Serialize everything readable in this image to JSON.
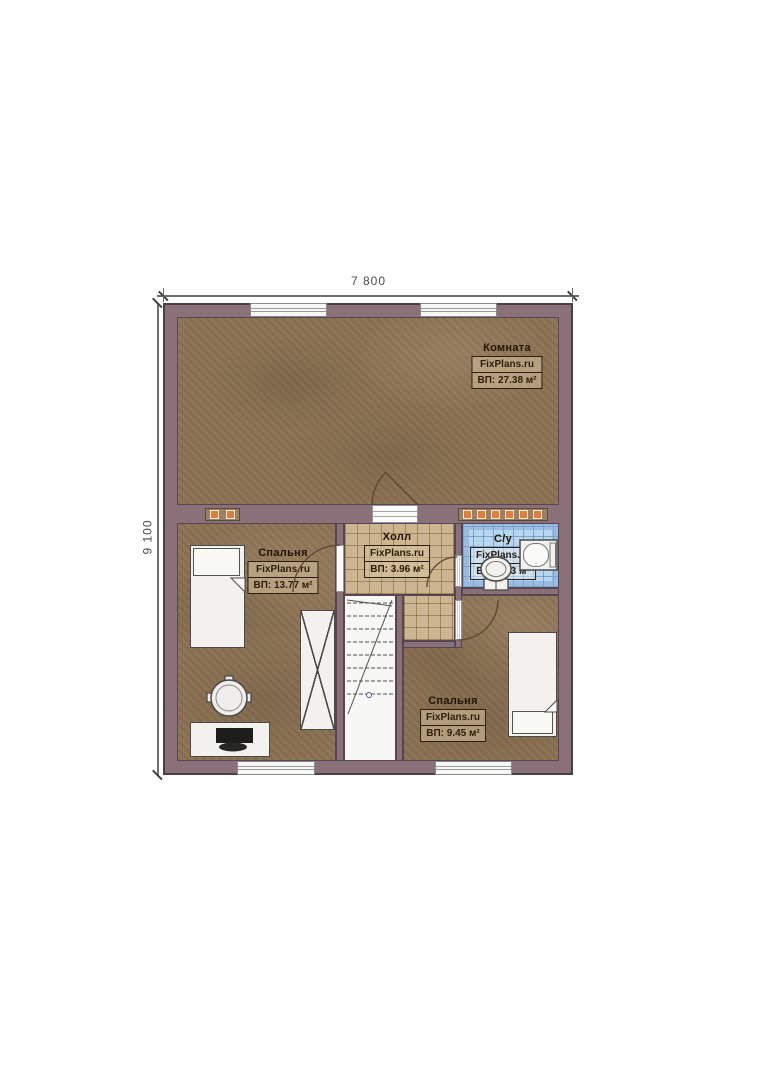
{
  "plan": {
    "dimensions": {
      "width": "7 800",
      "height": "9 100"
    },
    "rooms": [
      {
        "name": "Комната",
        "watermark": "FixPlans.ru",
        "area": "ВП: 27.38 м²"
      },
      {
        "name": "Спальня",
        "watermark": "FixPlans.ru",
        "area": "ВП: 13.77 м²"
      },
      {
        "name": "Холл",
        "watermark": "FixPlans.ru",
        "area": "ВП: 3.96 м²"
      },
      {
        "name": "С/у",
        "watermark": "FixPlans.ru",
        "area": "ВП: 2.43 м²"
      },
      {
        "name": "Спальня",
        "watermark": "FixPlans.ru",
        "area": "ВП: 9.45 м²"
      }
    ],
    "colors": {
      "wall": "#8a7078",
      "floor": "#8c7254",
      "hall_tile": "#ccb590",
      "bath_tile": "#b7d6f0",
      "marker_orange": "#e07f3c",
      "furniture": "#f2f1ee"
    }
  }
}
